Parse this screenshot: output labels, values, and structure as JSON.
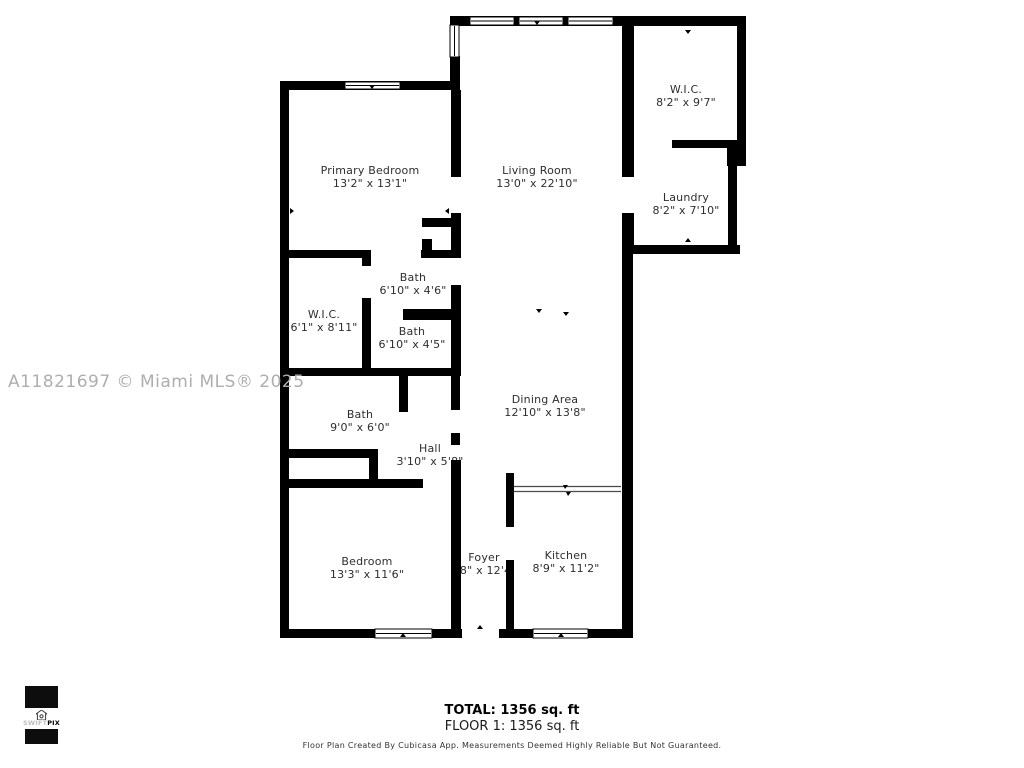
{
  "watermark": "A11821697 © Miami MLS® 2025",
  "rooms": [
    {
      "name": "Primary Bedroom",
      "dims": "13'2\" x 13'1\""
    },
    {
      "name": "Living Room",
      "dims": "13'0\" x 22'10\""
    },
    {
      "name": "W.I.C.",
      "dims": "8'2\" x 9'7\""
    },
    {
      "name": "Laundry",
      "dims": "8'2\" x 7'10\""
    },
    {
      "name": "Bath",
      "dims": "6'10\" x 4'6\""
    },
    {
      "name": "W.I.C.",
      "dims": "6'1\" x 8'11\""
    },
    {
      "name": "Bath",
      "dims": "6'10\" x 4'5\""
    },
    {
      "name": "Bath",
      "dims": "9'0\" x 6'0\""
    },
    {
      "name": "Hall",
      "dims": "3'10\" x 5'8\""
    },
    {
      "name": "Dining Area",
      "dims": "12'10\" x 13'8\""
    },
    {
      "name": "Bedroom",
      "dims": "13'3\" x 11'6\""
    },
    {
      "name": "Foyer",
      "dims": "'8\" x 12'4"
    },
    {
      "name": "Kitchen",
      "dims": "8'9\" x 11'2\""
    }
  ],
  "summary": {
    "total": "TOTAL: 1356 sq. ft",
    "floor": "FLOOR 1: 1356 sq. ft"
  },
  "disclaimer": "Floor Plan Created By Cubicasa App. Measurements Deemed Highly Reliable But Not Guaranteed.",
  "logo": {
    "brand_light": "SWIFT",
    "brand_bold": "PIX"
  },
  "colors": {
    "wall": "#000000",
    "label_text": "#2e2e2e",
    "watermark": "#aeaeae"
  }
}
